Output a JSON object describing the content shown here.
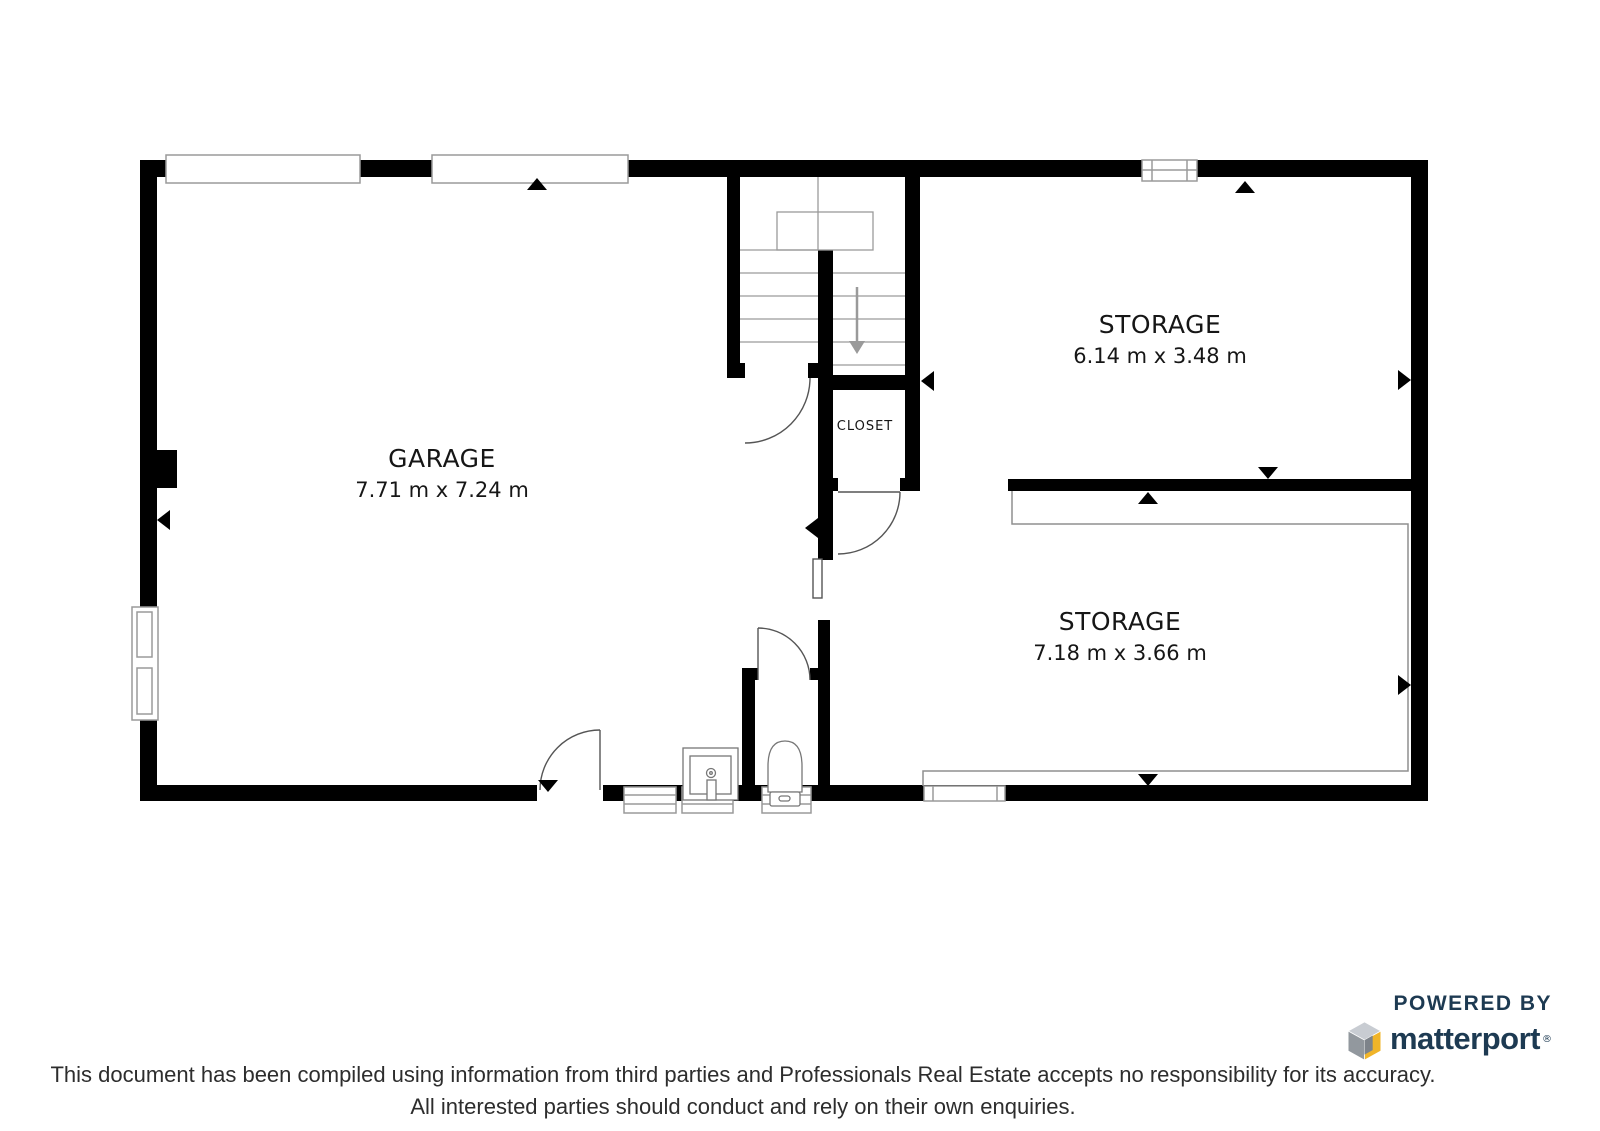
{
  "page": {
    "background": "#ffffff"
  },
  "floorplan": {
    "rooms": [
      {
        "id": "garage",
        "name": "GARAGE",
        "dimensions": "7.71 m x 7.24 m"
      },
      {
        "id": "storage-upper",
        "name": "STORAGE",
        "dimensions": "6.14 m x 3.48 m"
      },
      {
        "id": "storage-lower",
        "name": "STORAGE",
        "dimensions": "7.18 m x 3.66 m"
      },
      {
        "id": "closet",
        "name": "CLOSET"
      }
    ],
    "colors": {
      "wall": "#000000",
      "thin_outline": "#8f8f8f",
      "stair_arrow": "#9a9a9a",
      "door_stroke": "#555555"
    }
  },
  "branding": {
    "powered_by": "POWERED BY",
    "brand": "matterport",
    "registered": "®",
    "brand_color": "#1d3a52",
    "cube_yellow": "#f0b429",
    "cube_gray_top": "#c8ccd2",
    "cube_gray_side": "#92989e"
  },
  "disclaimer": {
    "line1": "This document has been compiled using information from third parties and Professionals Real Estate accepts no responsibility for its accuracy.",
    "line2": "All interested parties should conduct and rely on their own enquiries."
  }
}
